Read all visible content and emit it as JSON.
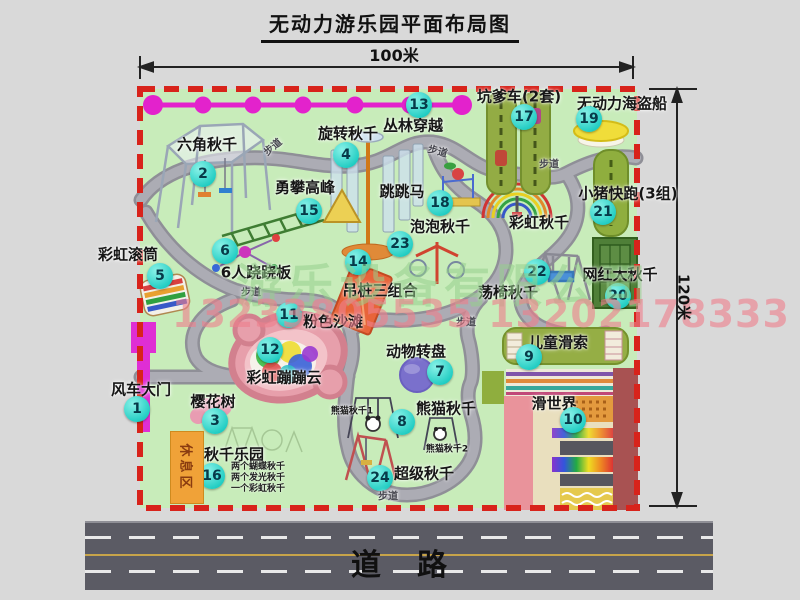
{
  "title": "无动力游乐园平面布局图",
  "dimensions": {
    "width_label": "100米",
    "height_label": "120米"
  },
  "road": {
    "label": "道路"
  },
  "rest_area": {
    "label": "休息区"
  },
  "watermark": {
    "company": "游乐设备有限公司",
    "phone": "13233805535 13202178333"
  },
  "colors": {
    "map_green": "#c8ecba",
    "border_red": "#d8231b",
    "badge_fill": "#1fccc2",
    "badge_text": "#073a49",
    "zipline_magenta": "#e322cc",
    "gate_magenta": "#df2ed4",
    "rest_orange": "#f0a238",
    "road_gray": "#5b5b64",
    "path_gray": "#acacb4",
    "watermark_green": "#96d08c",
    "watermark_pink": "#ee808c"
  },
  "attractions": [
    {
      "num": "1",
      "name": "风车大门",
      "bx": 137,
      "by": 409,
      "lx": 141,
      "ly": 389
    },
    {
      "num": "2",
      "name": "六角秋千",
      "bx": 203,
      "by": 174,
      "lx": 207,
      "ly": 144
    },
    {
      "num": "3",
      "name": "樱花树",
      "bx": 215,
      "by": 421,
      "lx": 213,
      "ly": 401
    },
    {
      "num": "4",
      "name": "旋转秋千",
      "bx": 346,
      "by": 155,
      "lx": 348,
      "ly": 133
    },
    {
      "num": "5",
      "name": "彩虹滚筒",
      "bx": 160,
      "by": 276,
      "lx": 128,
      "ly": 254
    },
    {
      "num": "6",
      "name": "6人跷跷板",
      "bx": 225,
      "by": 251,
      "lx": 256,
      "ly": 272
    },
    {
      "num": "7",
      "name": "动物转盘",
      "bx": 440,
      "by": 372,
      "lx": 416,
      "ly": 351
    },
    {
      "num": "8",
      "name": "熊猫秋千",
      "bx": 402,
      "by": 422,
      "lx": 446,
      "ly": 408
    },
    {
      "num": "9",
      "name": "儿童滑索",
      "bx": 529,
      "by": 357,
      "lx": 558,
      "ly": 342
    },
    {
      "num": "10",
      "name": "滑世界",
      "bx": 573,
      "by": 420,
      "lx": 554,
      "ly": 403
    },
    {
      "num": "11",
      "name": "粉色沙滩",
      "bx": 289,
      "by": 315,
      "lx": 333,
      "ly": 321
    },
    {
      "num": "12",
      "name": "彩虹蹦蹦云",
      "bx": 270,
      "by": 350,
      "lx": 284,
      "ly": 377
    },
    {
      "num": "13",
      "name": "丛林穿越",
      "bx": 419,
      "by": 105,
      "lx": 413,
      "ly": 125
    },
    {
      "num": "14",
      "name": "吊桩三组合",
      "bx": 358,
      "by": 262,
      "lx": 380,
      "ly": 290
    },
    {
      "num": "15",
      "name": "勇攀高峰",
      "bx": 309,
      "by": 211,
      "lx": 305,
      "ly": 187
    },
    {
      "num": "16",
      "name": "秋千乐园",
      "bx": 212,
      "by": 476,
      "lx": 234,
      "ly": 454
    },
    {
      "num": "17",
      "name": "坑爹车(2套)",
      "bx": 524,
      "by": 117,
      "lx": 519,
      "ly": 96
    },
    {
      "num": "18",
      "name": "跳跳马",
      "bx": 440,
      "by": 203,
      "lx": 402,
      "ly": 191
    },
    {
      "num": "19",
      "name": "无动力海盗船",
      "bx": 589,
      "by": 119,
      "lx": 622,
      "ly": 103
    },
    {
      "num": "20",
      "name": "网红大秋千",
      "bx": 618,
      "by": 296,
      "lx": 620,
      "ly": 274
    },
    {
      "num": "21",
      "name": "小猪快跑(3组)",
      "bx": 603,
      "by": 212,
      "lx": 628,
      "ly": 193
    },
    {
      "num": "22",
      "name": "荡椅秋千",
      "bx": 537,
      "by": 272,
      "lx": 508,
      "ly": 292
    },
    {
      "num": "23",
      "name": "泡泡秋千",
      "bx": 400,
      "by": 244,
      "lx": 440,
      "ly": 226
    },
    {
      "num": "24",
      "name": "超级秋千",
      "bx": 380,
      "by": 478,
      "lx": 424,
      "ly": 473
    }
  ],
  "extra_labels": [
    {
      "text": "彩虹秋千",
      "x": 539,
      "y": 222,
      "size": 15
    },
    {
      "text": "熊猫秋千1",
      "x": 352,
      "y": 410,
      "size": 9
    },
    {
      "text": "熊猫秋千2",
      "x": 447,
      "y": 448,
      "size": 9
    }
  ],
  "path_labels": [
    {
      "text": "步道",
      "x": 272,
      "y": 146,
      "rot": -40
    },
    {
      "text": "步道",
      "x": 438,
      "y": 150,
      "rot": 15
    },
    {
      "text": "步道",
      "x": 549,
      "y": 163,
      "rot": 0
    },
    {
      "text": "步道",
      "x": 251,
      "y": 291,
      "rot": 0
    },
    {
      "text": "步道",
      "x": 466,
      "y": 321,
      "rot": 0
    },
    {
      "text": "步道",
      "x": 388,
      "y": 495,
      "rot": 0
    }
  ],
  "swing_notes": {
    "x": 231,
    "y": 462,
    "lines": [
      "两个蝴蝶秋千",
      "两个发光秋千",
      "一个彩虹秋千"
    ]
  }
}
